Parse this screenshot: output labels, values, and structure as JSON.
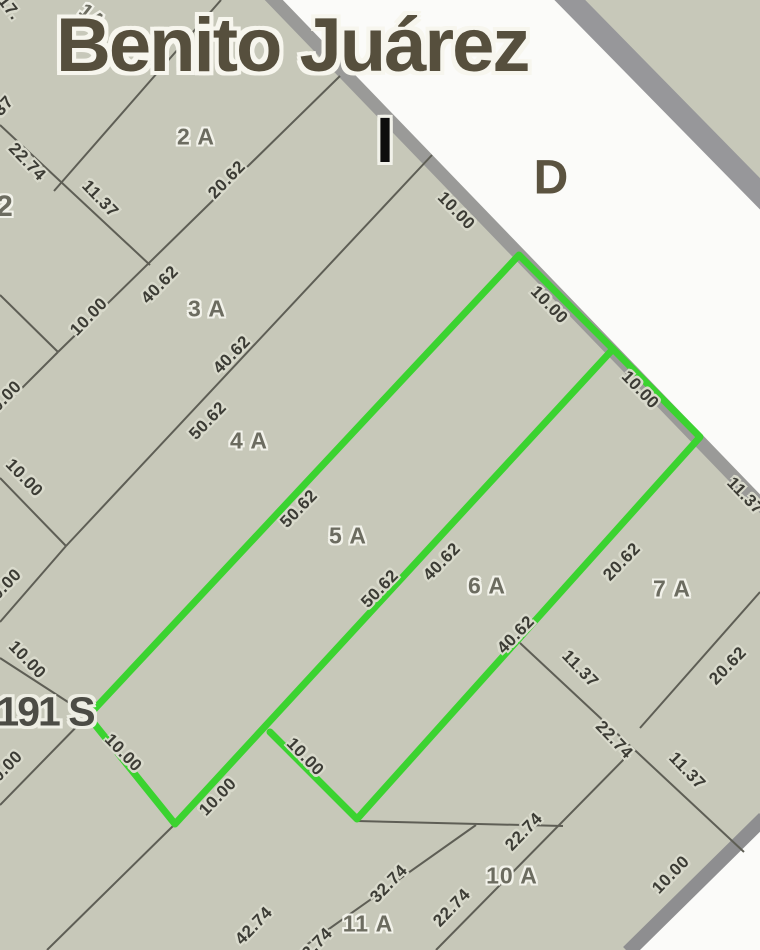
{
  "map": {
    "street_name": "Benito Juárez",
    "block_letter": "I",
    "direction_letter": "D",
    "corner_marker": "191 S",
    "highlighted_parcels": [
      "5 A",
      "6 A"
    ],
    "colors": {
      "background": "#c7c8b9",
      "street_fill": "#fbfbf9",
      "street_border": "#9a9a98",
      "parcel_line": "#5e5e55",
      "highlight_green": "#3bd330",
      "dimension_text": "#3b3b34",
      "parcel_text": "#6c6c60",
      "title_text": "#564f3d"
    },
    "parcel_labels": [
      {
        "text": "1A",
        "x": 92,
        "y": 17,
        "rot": 38,
        "size": 20
      },
      {
        "text": "2 A",
        "x": 196,
        "y": 137,
        "rot": 0,
        "size": 23
      },
      {
        "text": "3 A",
        "x": 207,
        "y": 309,
        "rot": 0,
        "size": 23
      },
      {
        "text": "4 A",
        "x": 249,
        "y": 441,
        "rot": 0,
        "size": 23
      },
      {
        "text": "5 A",
        "x": 348,
        "y": 536,
        "rot": 0,
        "size": 23
      },
      {
        "text": "6 A",
        "x": 487,
        "y": 586,
        "rot": 0,
        "size": 23
      },
      {
        "text": "7 A",
        "x": 672,
        "y": 589,
        "rot": 0,
        "size": 23
      },
      {
        "text": "10 A",
        "x": 512,
        "y": 876,
        "rot": 0,
        "size": 23
      },
      {
        "text": "11 A",
        "x": 368,
        "y": 924,
        "rot": 0,
        "size": 23
      },
      {
        "text": "2",
        "x": 5,
        "y": 207,
        "rot": 0,
        "size": 30
      }
    ],
    "dimension_labels": [
      {
        "text": "17.",
        "x": 9,
        "y": 8,
        "rot": 52
      },
      {
        "text": "37",
        "x": 4,
        "y": 106,
        "rot": -48
      },
      {
        "text": "22.74",
        "x": 27,
        "y": 162,
        "rot": 46
      },
      {
        "text": "11.37",
        "x": 100,
        "y": 199,
        "rot": 46
      },
      {
        "text": "20.62",
        "x": 227,
        "y": 180,
        "rot": -46
      },
      {
        "text": "40.62",
        "x": 160,
        "y": 285,
        "rot": -46
      },
      {
        "text": "10.00",
        "x": 89,
        "y": 317,
        "rot": -46
      },
      {
        "text": "40.62",
        "x": 232,
        "y": 355,
        "rot": -46
      },
      {
        "text": "50.62",
        "x": 208,
        "y": 421,
        "rot": -46
      },
      {
        "text": "10.00",
        "x": 456,
        "y": 211,
        "rot": 46
      },
      {
        "text": "10.00",
        "x": 549,
        "y": 305,
        "rot": 46
      },
      {
        "text": "10.00",
        "x": 640,
        "y": 390,
        "rot": 46
      },
      {
        "text": "11.37",
        "x": 745,
        "y": 496,
        "rot": 46
      },
      {
        "text": "10.00",
        "x": 3,
        "y": 400,
        "rot": -46
      },
      {
        "text": "10.00",
        "x": 24,
        "y": 478,
        "rot": 46
      },
      {
        "text": "10.00",
        "x": 3,
        "y": 588,
        "rot": -46
      },
      {
        "text": "10.00",
        "x": 27,
        "y": 660,
        "rot": 46
      },
      {
        "text": "10.00",
        "x": 4,
        "y": 770,
        "rot": -46
      },
      {
        "text": "10.00",
        "x": 123,
        "y": 753,
        "rot": 46
      },
      {
        "text": "10.00",
        "x": 218,
        "y": 797,
        "rot": -46
      },
      {
        "text": "10.00",
        "x": 305,
        "y": 757,
        "rot": 46
      },
      {
        "text": "50.62",
        "x": 299,
        "y": 509,
        "rot": -46
      },
      {
        "text": "50.62",
        "x": 380,
        "y": 589,
        "rot": -46
      },
      {
        "text": "40.62",
        "x": 442,
        "y": 562,
        "rot": -46
      },
      {
        "text": "40.62",
        "x": 516,
        "y": 635,
        "rot": -46
      },
      {
        "text": "20.62",
        "x": 622,
        "y": 562,
        "rot": -46
      },
      {
        "text": "20.62",
        "x": 728,
        "y": 666,
        "rot": -46
      },
      {
        "text": "11.37",
        "x": 580,
        "y": 669,
        "rot": 46
      },
      {
        "text": "22.74",
        "x": 614,
        "y": 740,
        "rot": 46
      },
      {
        "text": "11.37",
        "x": 687,
        "y": 771,
        "rot": 46
      },
      {
        "text": "22.74",
        "x": 524,
        "y": 832,
        "rot": -46
      },
      {
        "text": "32.74",
        "x": 389,
        "y": 884,
        "rot": -46
      },
      {
        "text": "22.74",
        "x": 452,
        "y": 908,
        "rot": -46
      },
      {
        "text": "42.74",
        "x": 254,
        "y": 926,
        "rot": -46
      },
      {
        "text": "32.74",
        "x": 314,
        "y": 947,
        "rot": -46
      },
      {
        "text": "10.00",
        "x": 671,
        "y": 875,
        "rot": -46
      }
    ]
  }
}
